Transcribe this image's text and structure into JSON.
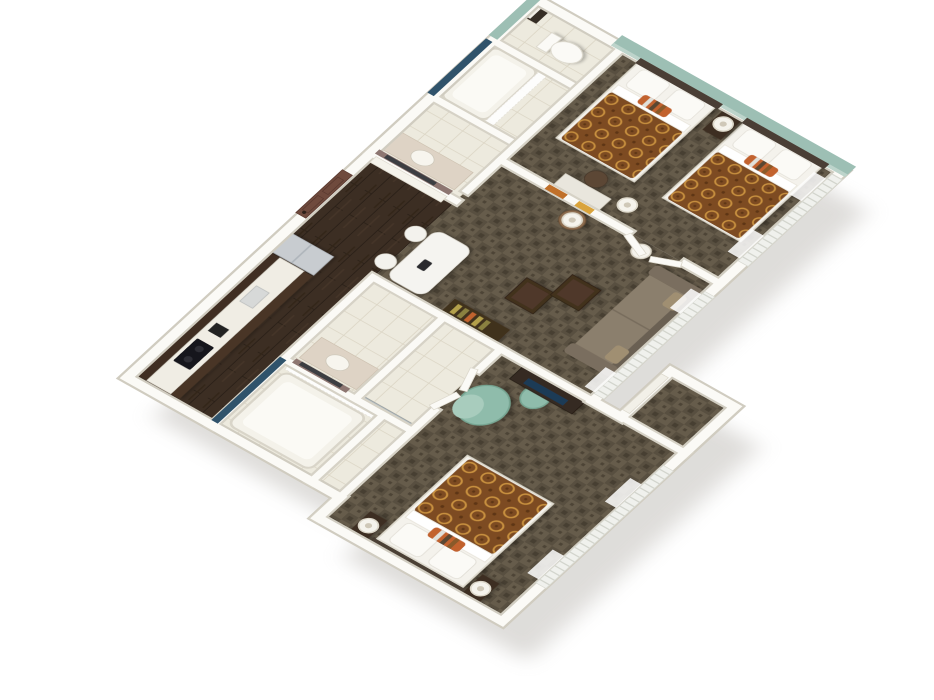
{
  "scene": {
    "title": "3D cutaway floor plan of a two-bedroom hotel suite",
    "view": "aerial three-quarter isometric, rotated about 52 degrees, white background with soft drop shadow"
  },
  "palette": {
    "background": "#ffffff",
    "wall_white": "#fbfaf6",
    "wall_edge": "#d6d2c6",
    "teal_accent_wall": "#9dbfb4",
    "teal_accent_light": "#bdd4cb",
    "carpet_brown": "#5f5546",
    "carpet_dark": "#473f32",
    "wood_floor": "#3c2e23",
    "tile_cream": "#edeade",
    "bedspread_rust": "#7d4b20",
    "bedspread_ring": "#c99140",
    "stripe_navy": "#30536b",
    "vanity_mauve": "#8d7671",
    "door_brown": "#6f4a3d",
    "furniture_espresso": "#3c2e22",
    "sofa_taupe": "#8b7f6d",
    "sofa_frame": "#6b6052",
    "chair_seafoam": "#8fbcab",
    "appliance_steel": "#c8ccd0",
    "tv_screen": "#1d3b57",
    "mirror_dark": "#3c3e42",
    "shadow_grey": "#b7b4ae"
  },
  "rooms": [
    {
      "id": "bathroom-1",
      "name": "Bathroom 1 (top)",
      "floor": "cream tile",
      "furniture": [
        "vanity with dark mirror and mauve wall",
        "bathtub with navy tile stripe",
        "white shower curtain",
        "toilet",
        "towel shelf"
      ]
    },
    {
      "id": "kitchen",
      "name": "Kitchen",
      "floor": "dark hardwood",
      "furniture": [
        "dark upper cabinets",
        "white countertop",
        "black cooktop",
        "small appliances",
        "stainless refrigerator",
        "dark lower cabinets"
      ]
    },
    {
      "id": "entry",
      "name": "Entry hall",
      "floor": "dark hardwood",
      "furniture": [
        "brown paneled entry door",
        "louvered closet door"
      ]
    },
    {
      "id": "living-room",
      "name": "Living / dining room",
      "floor": "patterned brown carpet",
      "furniture": [
        "white dining table",
        "two white chairs",
        "black telephone",
        "console with books",
        "sofa",
        "two espresso ottomans",
        "side table with lamp",
        "floor lamp",
        "orange wall art",
        "windows with vertical blinds and sheer curtains"
      ]
    },
    {
      "id": "bedroom-1",
      "name": "Bedroom 1 (two queens)",
      "floor": "patterned brown carpet",
      "furniture": [
        "queen bed with rust patterned spread ×2",
        "striped accent pillows",
        "shared nightstand with lamp",
        "work desk",
        "brown desk chair",
        "floor lamp",
        "french doors",
        "windows with sheer curtains"
      ],
      "accent": "teal headboard wall with dark headboards"
    },
    {
      "id": "bathroom-2",
      "name": "Bathroom 2 + closets (left)",
      "floor": "cream tile",
      "furniture": [
        "bathtub with navy tile stripe",
        "white shower curtain",
        "vanity with dark mirror and mauve wall",
        "mirrored sliding closet doors"
      ]
    },
    {
      "id": "bedroom-2",
      "name": "Bedroom 2 (king)",
      "floor": "patterned brown carpet",
      "furniture": [
        "king bed with rust patterned spread",
        "striped accent pillow",
        "nightstand with lamp ×2",
        "seafoam lounge chair",
        "seafoam ottoman",
        "espresso TV dresser with television",
        "french doors",
        "walk-in closet",
        "windows with sheer curtains"
      ]
    }
  ]
}
